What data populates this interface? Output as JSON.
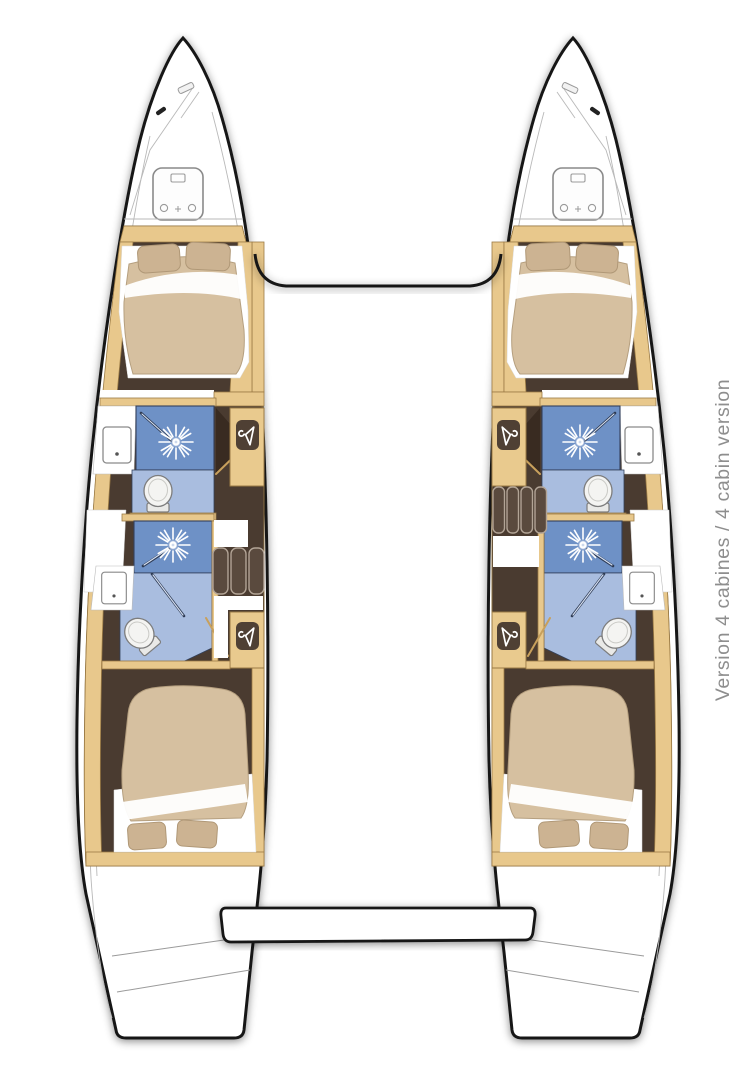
{
  "caption": {
    "text": "Version 4 cabines / 4 cabin version",
    "color": "#8e8e8e"
  },
  "diagram": {
    "type": "catamaran-floorplan",
    "view": "top-down deck plan",
    "cabins_total": 4,
    "bathrooms_total": 4,
    "shared_elements": [
      "bow-trampoline-beam",
      "aft-swim-platform"
    ],
    "hulls": [
      {
        "name": "port-hull",
        "side": "left",
        "companionway_steps": 3,
        "features": [
          "bow-anchor-locker",
          "deck-hatch",
          "forward-double-berth-2-pillows",
          "forward-head-shower",
          "forward-head-toilet",
          "forward-head-sink",
          "forward-wardrobe",
          "companionway-steps",
          "aft-head-shower",
          "aft-head-toilet",
          "aft-head-sink",
          "aft-wardrobe",
          "aft-double-berth-2-pillows",
          "stern-swim-steps"
        ]
      },
      {
        "name": "starboard-hull",
        "side": "right",
        "companionway_steps": 4,
        "features": [
          "bow-anchor-locker",
          "deck-hatch",
          "forward-double-berth-2-pillows",
          "forward-head-shower",
          "forward-head-toilet",
          "forward-head-sink",
          "forward-wardrobe",
          "companionway-steps",
          "aft-head-shower",
          "aft-head-toilet",
          "aft-head-sink",
          "aft-wardrobe",
          "aft-double-berth-2-pillows",
          "stern-swim-steps"
        ]
      }
    ]
  },
  "colors": {
    "background": "#ffffff",
    "hull_outline": "#181818",
    "woodwork_tan": "#e8c88c",
    "cabin_floor_dark_brown": "#4a3b30",
    "shower_blue": "#6e91c6",
    "bathroom_floor_blue": "#a9bddf",
    "mattress_beige": "#d6c0a0",
    "pillow_beige": "#ccb392",
    "fixture_white": "#f4f4f2",
    "caption_gray": "#8e8e8e"
  }
}
